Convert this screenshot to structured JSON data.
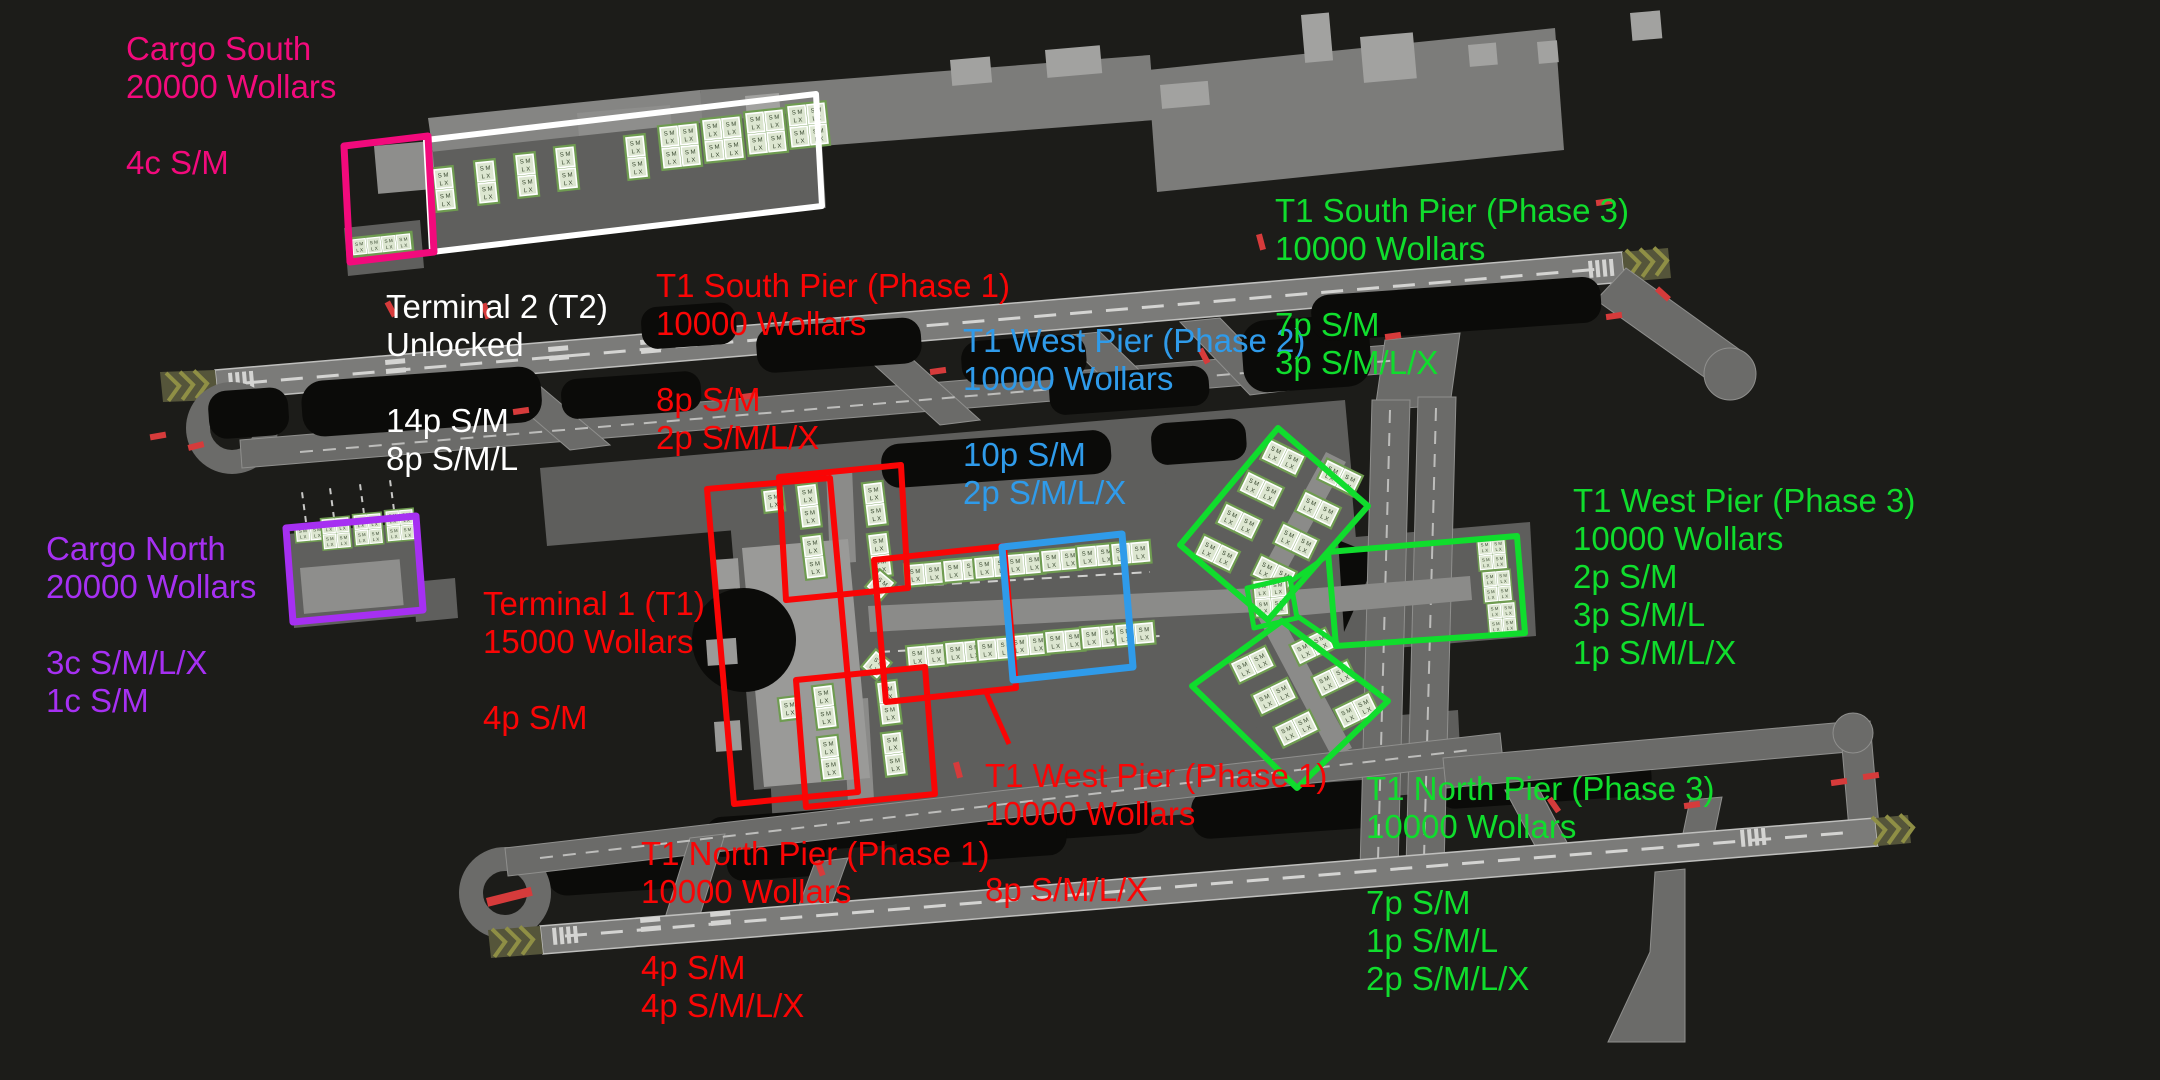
{
  "game": {
    "currency": "Wollars",
    "map_type": "airport-top-down-view"
  },
  "colors": {
    "background": "#1c1c19",
    "zone_cargo": "#F20A7C",
    "zone_unlocked": "#FFFFFF",
    "zone_phase1": "#FA0505",
    "zone_phase2": "#2F9BEA",
    "zone_phase3": "#10DD2D",
    "zone_cargo_north": "#A630F2",
    "stand_pad_green": "#6f9c51",
    "taxiway_gray": "#6b6b69",
    "runway_gray": "#7b7b79"
  },
  "map": {
    "pad_letters_top": "S M",
    "pad_letters_bottom": "L X"
  },
  "annotations": [
    {
      "id": "cargo-south",
      "color": "#F20A7C",
      "lines": [
        "Cargo South",
        "20000 Wollars",
        "",
        "4c S/M"
      ]
    },
    {
      "id": "terminal-2",
      "color": "#FFFFFF",
      "lines": [
        "Terminal 2 (T2)",
        "Unlocked",
        "",
        "14p S/M",
        "8p S/M/L"
      ]
    },
    {
      "id": "t1-south-pier-phase1",
      "color": "#FA0505",
      "lines": [
        "T1 South Pier (Phase 1)",
        "10000 Wollars",
        "",
        "8p S/M",
        "2p S/M/L/X"
      ]
    },
    {
      "id": "t1-west-pier-phase2",
      "color": "#2F9BEA",
      "lines": [
        "T1 West Pier (Phase 2)",
        "10000 Wollars",
        "",
        "10p S/M",
        "2p S/M/L/X"
      ]
    },
    {
      "id": "t1-south-pier-phase3",
      "color": "#10DD2D",
      "lines": [
        "T1 South Pier (Phase 3)",
        "10000 Wollars",
        "",
        "7p S/M",
        "3p S/M/L/X"
      ]
    },
    {
      "id": "t1-west-pier-phase3",
      "color": "#10DD2D",
      "lines": [
        "T1 West Pier (Phase 3)",
        "10000 Wollars",
        "2p S/M",
        "3p S/M/L",
        "1p S/M/L/X"
      ]
    },
    {
      "id": "cargo-north",
      "color": "#A630F2",
      "lines": [
        "Cargo North",
        "20000 Wollars",
        "",
        "3c S/M/L/X",
        "1c S/M"
      ]
    },
    {
      "id": "terminal-1",
      "color": "#FA0505",
      "lines": [
        "Terminal 1 (T1)",
        "15000 Wollars",
        "",
        "4p S/M"
      ]
    },
    {
      "id": "t1-west-pier-phase1",
      "color": "#FA0505",
      "lines": [
        "T1 West Pier (Phase 1)",
        "10000 Wollars",
        "",
        "8p S/M/L/X"
      ]
    },
    {
      "id": "t1-north-pier-phase1",
      "color": "#FA0505",
      "lines": [
        "T1 North Pier (Phase 1)",
        "10000 Wollars",
        "",
        "4p S/M",
        "4p S/M/L/X"
      ]
    },
    {
      "id": "t1-north-pier-phase3",
      "color": "#10DD2D",
      "lines": [
        "T1 North Pier (Phase 3)",
        "10000 Wollars",
        "",
        "7p S/M",
        "1p S/M/L",
        "2p S/M/L/X"
      ]
    }
  ]
}
